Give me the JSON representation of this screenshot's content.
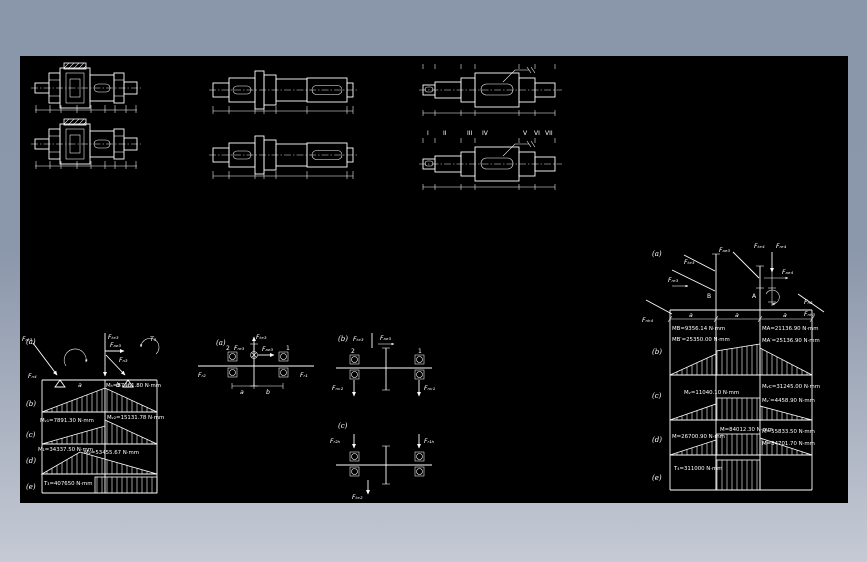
{
  "window": {
    "canvas_bg": "#000000",
    "frame_top_color": "#8a96aa",
    "frame_bottom_color": "#c5cad4",
    "line_color": "#ffffff"
  },
  "top_views": {
    "roman_labels": [
      "I",
      "II",
      "III",
      "IV",
      "V",
      "VI",
      "VII"
    ]
  },
  "left_diagram": {
    "letters": [
      "(a)",
      "(b)",
      "(c)",
      "(d)",
      "(e)"
    ],
    "f_tangential": "Fₜₑ₃",
    "f_axial": "Fₐₑ₃",
    "f_radial": "Fᵣₑ₃",
    "r_left": "Fₙ₄",
    "r_right": "Fₙ₃",
    "torque": "T₃",
    "dim_a": "a",
    "dim_b": "b",
    "m_b": "Mₕ=87961.80 N·mm",
    "m_c1": "Mᵥ₁=7891.30 N·mm",
    "m_c2": "Mᵥ₂=15131.78 N·mm",
    "m_d1": "M₁=34337.50 N·mm",
    "m_d2": "M₂=53455.67 N·mm",
    "m_e": "T₃=407650 N·mm"
  },
  "mid_a": {
    "letter": "(a)",
    "n_left": "2",
    "n_right": "1",
    "f_up": "Fₜₑ₃",
    "f_right": "Fₐₑ₃",
    "f_center": "Fᵣₑ₃",
    "r_left": "Fᵣ₂",
    "r_right": "Fᵣ₁",
    "dim_a": "a",
    "dim_b": "b"
  },
  "mid_b": {
    "letter": "(b)",
    "n_left": "2",
    "n_right": "1",
    "f_top1": "Fₜₑ₃",
    "f_top2": "Fₐₑ₃",
    "r_left": "Fₙᵥ₂",
    "r_right": "Fₙᵥ₁"
  },
  "mid_c": {
    "letter": "(c)",
    "f_left": "Fᵣ₂ₕ",
    "f_right": "Fᵣ₁ₕ",
    "f_bottom": "Fₜₑ₂"
  },
  "right_diagram": {
    "letters": [
      "(a)",
      "(b)",
      "(c)",
      "(d)",
      "(e)"
    ],
    "point_b": "B",
    "point_a": "A",
    "f_te3": "Fₜₑ₃",
    "f_ae3": "Fₐₑ₃",
    "f_re3": "Fᵣₑ₃",
    "f_te4": "Fₜₑ₄",
    "f_ae4": "Fₐₑ₄",
    "f_re4": "Fᵣₑ₄",
    "r_left": "Fₙₕ₄",
    "r_right1": "Fₙ₃",
    "r_right2": "Fₙₕ₃",
    "dims": [
      "a",
      "a",
      "a"
    ],
    "m_b1": "MB=9356.14 N·mm",
    "m_b2": "MB′=25350.00 N·mm",
    "m_b3": "MA=21136.90 N·mm",
    "m_b4": "MA′=25136.90 N·mm",
    "m_c1": "Mᵥ=11040.10 N·mm",
    "m_c2": "Mᵥc=31245.00 N·mm",
    "m_c3": "Mᵥ′=4458.90 N·mm",
    "m_d1": "M=26700.90 N·mm",
    "m_d2": "M=84012.30 N·mm",
    "m_d3": "M=55833.50 N·mm",
    "m_d4": "M=34701.70 N·mm",
    "m_e": "T₄=311000 N·mm"
  }
}
